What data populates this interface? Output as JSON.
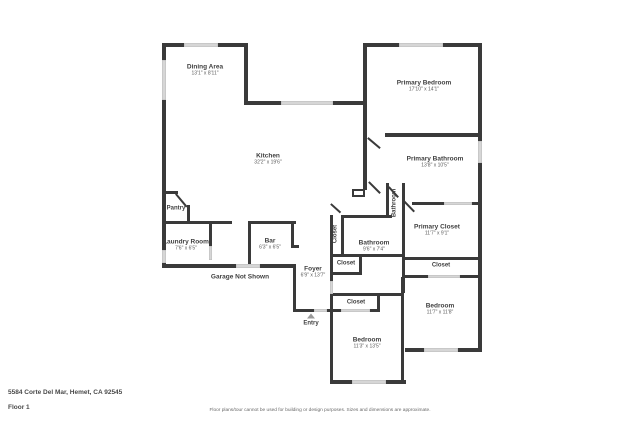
{
  "rooms": {
    "dining": {
      "name": "Dining Area",
      "dims": "13'1\" x 8'11\""
    },
    "kitchen": {
      "name": "Kitchen",
      "dims": "32'2\" x 19'6\""
    },
    "primary_bedroom": {
      "name": "Primary Bedroom",
      "dims": "17'10\" x 14'1\""
    },
    "primary_bathroom": {
      "name": "Primary Bathroom",
      "dims": "13'8\" x 10'5\""
    },
    "primary_closet": {
      "name": "Primary Closet",
      "dims": "11'7\" x 9'1\""
    },
    "bathroom": {
      "name": "Bathroom",
      "dims": "9'6\" x 7'4\""
    },
    "bathroom_rotated": {
      "name": "Bathroom"
    },
    "closet_rotated": {
      "name": "Closet"
    },
    "closet_hall": {
      "name": "Closet"
    },
    "closet_right": {
      "name": "Closet"
    },
    "closet_bedroom": {
      "name": "Closet"
    },
    "bedroom_left": {
      "name": "Bedroom",
      "dims": "11'3\" x 13'5\""
    },
    "bedroom_right": {
      "name": "Bedroom",
      "dims": "11'7\" x 11'8\""
    },
    "pantry": {
      "name": "Pantry"
    },
    "laundry": {
      "name": "Laundry Room",
      "dims": "7'6\" x 6'5\""
    },
    "bar": {
      "name": "Bar",
      "dims": "6'3\" x 6'5\""
    },
    "foyer": {
      "name": "Foyer",
      "dims": "6'9\" x 13'7\""
    },
    "garage_note": {
      "name": "Garage Not Shown"
    },
    "entry": {
      "name": "Entry"
    }
  },
  "footer": {
    "address": "5584 Corte Del Mar, Hemet, CA 92545",
    "floor": "Floor 1",
    "disclaimer": "Floor plans/tour cannot be used for building or design purposes. Sizes and dimensions are approximate."
  },
  "colors": {
    "wall": "#3a3a3a",
    "window": "#d6d6d6",
    "label": "#3f3f3f"
  }
}
